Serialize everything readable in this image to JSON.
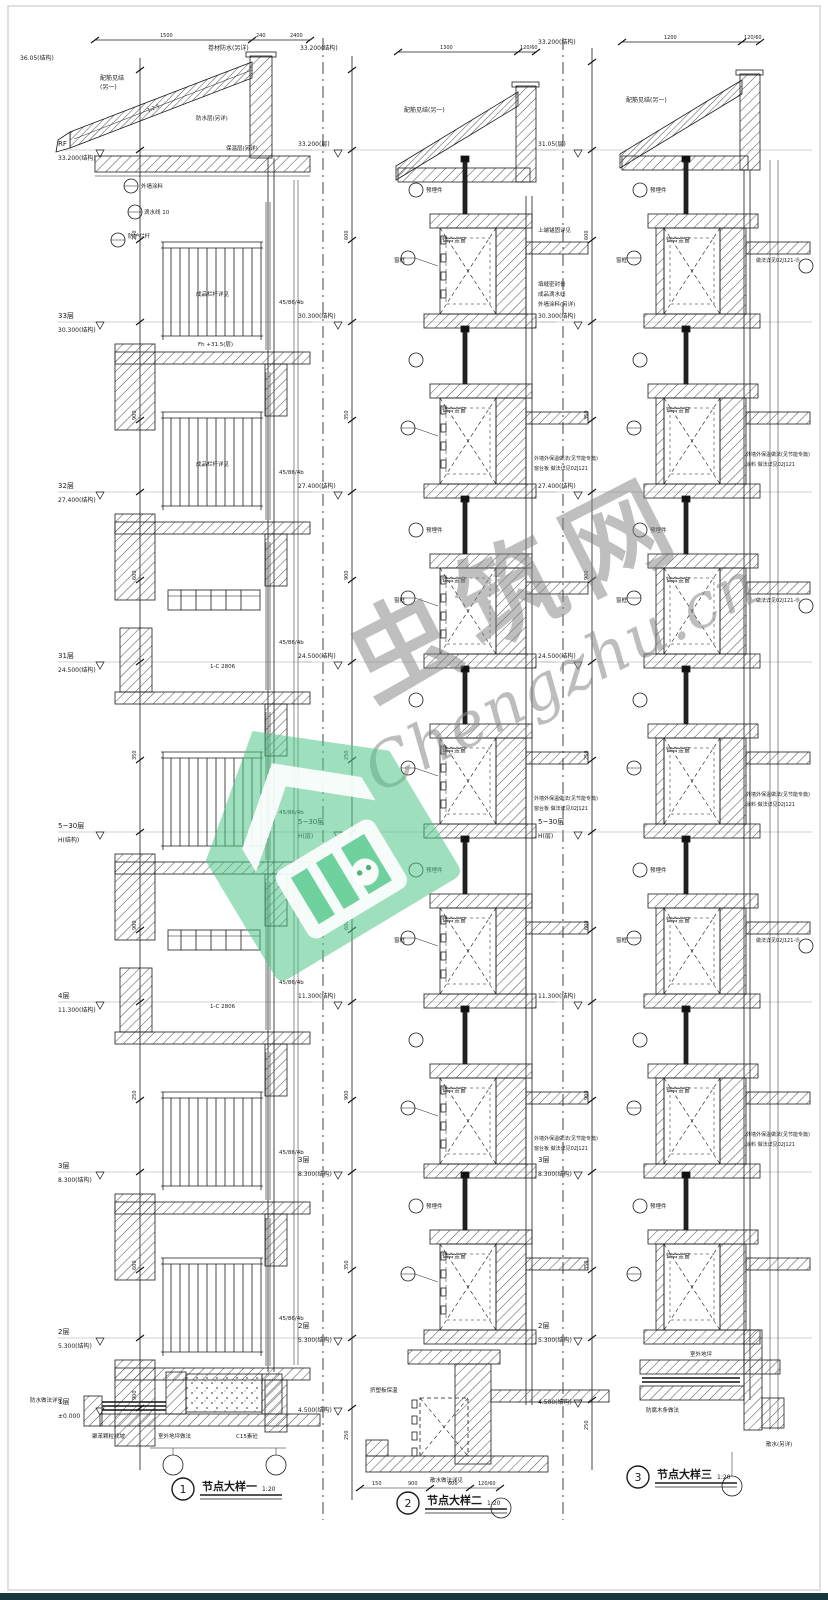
{
  "page": {
    "bottom_bar_color": "#14373c",
    "frame_color": "#d6d6d6"
  },
  "watermark": {
    "chars": "虫筑网",
    "latin": "Chengzhu.cn",
    "green": "#4ec687"
  },
  "titles": {
    "d1": {
      "num": "1",
      "label": "节点大样一",
      "scale": "1:20"
    },
    "d2": {
      "num": "2",
      "label": "节点大样二",
      "scale": "1:20"
    },
    "d3": {
      "num": "3",
      "label": "节点大样三",
      "scale": "1:20"
    }
  },
  "left": {
    "top_elev": "36.05(结构)",
    "levels": [
      {
        "floor": "RF",
        "elev": "33.200(结构)"
      },
      {
        "floor": "33层",
        "elev": "30.300(结构)"
      },
      {
        "floor": "32层",
        "elev": "27.400(结构)"
      },
      {
        "floor": "31层",
        "elev": "24.500(结构)"
      },
      {
        "floor": "5~30层",
        "elev": "H(结构)"
      },
      {
        "floor": "4层",
        "elev": "11.300(结构)"
      },
      {
        "floor": "3层",
        "elev": "8.300(结构)"
      },
      {
        "floor": "2层",
        "elev": "5.300(结构)"
      },
      {
        "floor": "1层",
        "elev": "±0.000"
      }
    ],
    "dims_top": [
      "1500",
      "240",
      "2400"
    ],
    "dims": [
      "250",
      "900",
      "600",
      "350",
      "900",
      "250",
      "600",
      "900",
      "150"
    ],
    "ann": {
      "roof1": "配筋见结",
      "roof2": "(另一)",
      "slope": "1:2.5",
      "eave1": "卷材防水(另详)",
      "eave2": "防水层(另详)",
      "eave3": "保温层(另详)",
      "paint": "外墙涂料",
      "drip": "滴水线 10",
      "rail_guard": "防护栏杆",
      "rail_ref": "成品栏杆详见",
      "ref_code": "45/86/4b",
      "level_note": "Fh +31.5(层)",
      "louver": "1-C 2806",
      "g1": "聚苯颗粒找坡",
      "g2": "室外地坪做法",
      "g3": "C15素砼",
      "g4": "防水做法详见"
    }
  },
  "mid": {
    "top_elev": "33.200(结构)",
    "levels": [
      {
        "elev": "33.200(层)"
      },
      {
        "elev": "30.300(结构)"
      },
      {
        "elev": "27.400(结构)"
      },
      {
        "elev": "24.500(结构)"
      },
      {
        "floor": "5~30层",
        "elev": "H(层)"
      },
      {
        "elev": "11.300(结构)"
      },
      {
        "floor": "3层",
        "elev": "8.300(结构)"
      },
      {
        "floor": "2层",
        "elev": "5.300(结构)"
      },
      {
        "elev": "4.500(结构)"
      }
    ],
    "dims_top": [
      "1300",
      "120/60"
    ],
    "dims_bottom": [
      "150",
      "900",
      "600",
      "120/60"
    ],
    "dims": [
      "600",
      "350",
      "900",
      "250",
      "600",
      "900",
      "350",
      "250",
      "100"
    ],
    "ann": {
      "roof1": "配筋见结(另一)",
      "anchor": "上端锚固详见",
      "blk1": "填缝密封膏",
      "blk2": "成品滴水线",
      "blk3": "外墙涂料(另详)",
      "window": "铝合金窗",
      "frame": "窗框",
      "embed": "预埋件",
      "insul1": "外墙外保温做法(见节能专篇)",
      "insul2": "窗台板 做法详见02J121",
      "g1": "挤塑板保温",
      "g2": "散水做法详见"
    }
  },
  "right": {
    "top_elev": "33.200(结构)",
    "levels": [
      {
        "elev": "31.05(层)"
      },
      {
        "elev": "30.300(结构)"
      },
      {
        "elev": "27.400(结构)"
      },
      {
        "elev": "24.500(结构)"
      },
      {
        "floor": "5~30层",
        "elev": "H(层)"
      },
      {
        "elev": "11.300(结构)"
      },
      {
        "floor": "3层",
        "elev": "8.300(结构)"
      },
      {
        "floor": "2层",
        "elev": "5.300(结构)"
      },
      {
        "elev": "4.500(结构)"
      }
    ],
    "dims_top": [
      "1200",
      "120/60"
    ],
    "dims": [
      "600",
      "350",
      "900",
      "250",
      "600",
      "900",
      "350",
      "250",
      "100"
    ],
    "ann": {
      "roof1": "配筋见结(另一)",
      "window": "铝合金窗",
      "frame": "窗框",
      "embed": "预埋件",
      "insul1": "外墙外保温做法(见节能专篇)",
      "insul2": "涂料 做法详见02J121",
      "extra": "做法详见02J121-Ⓑ",
      "g1": "防腐木条做法",
      "g2": "室外地坪",
      "g3": "散水(另详)"
    }
  }
}
